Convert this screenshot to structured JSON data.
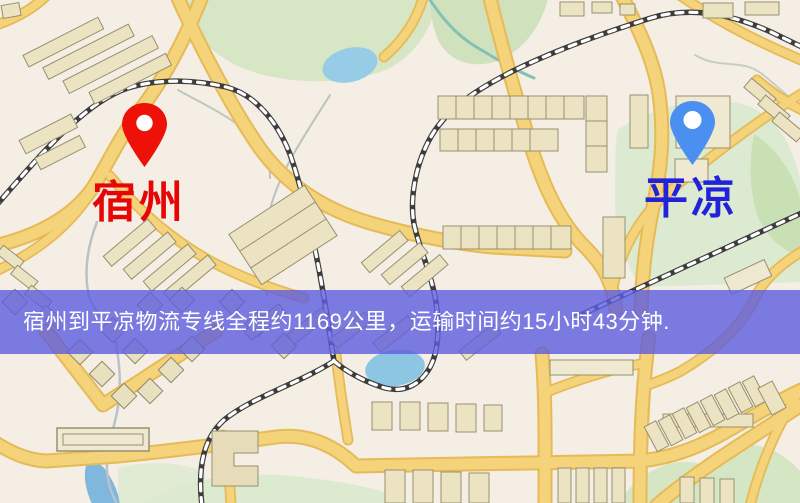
{
  "banner": {
    "text": "宿州到平凉物流专线全程约1169公里，运输时间约15小时43分钟.",
    "bg_color": "rgba(93,93,223,0.8)",
    "text_color": "#ffffff"
  },
  "origin": {
    "name": "宿州",
    "label_color": "#e60606",
    "pin_color": "#ee1108"
  },
  "destination": {
    "name": "平凉",
    "label_color": "#2222dd",
    "pin_color": "#4b90f0"
  },
  "route": {
    "distance_km": "1169",
    "duration": "15小时43分钟"
  },
  "map_palette": {
    "background": "#f4eee4",
    "road_fill": "#f4d37a",
    "road_edge": "#e5ba57",
    "road_fill_minor": "#f4d37a",
    "railway_dark": "#3d3d3d",
    "railway_light": "#ffffff",
    "green_area": "#d5e6c3",
    "green_area_dark": "#c9dfb4",
    "water": "#96cce6",
    "building_fill": "#ece3c3",
    "building_stroke": "#97906f"
  }
}
